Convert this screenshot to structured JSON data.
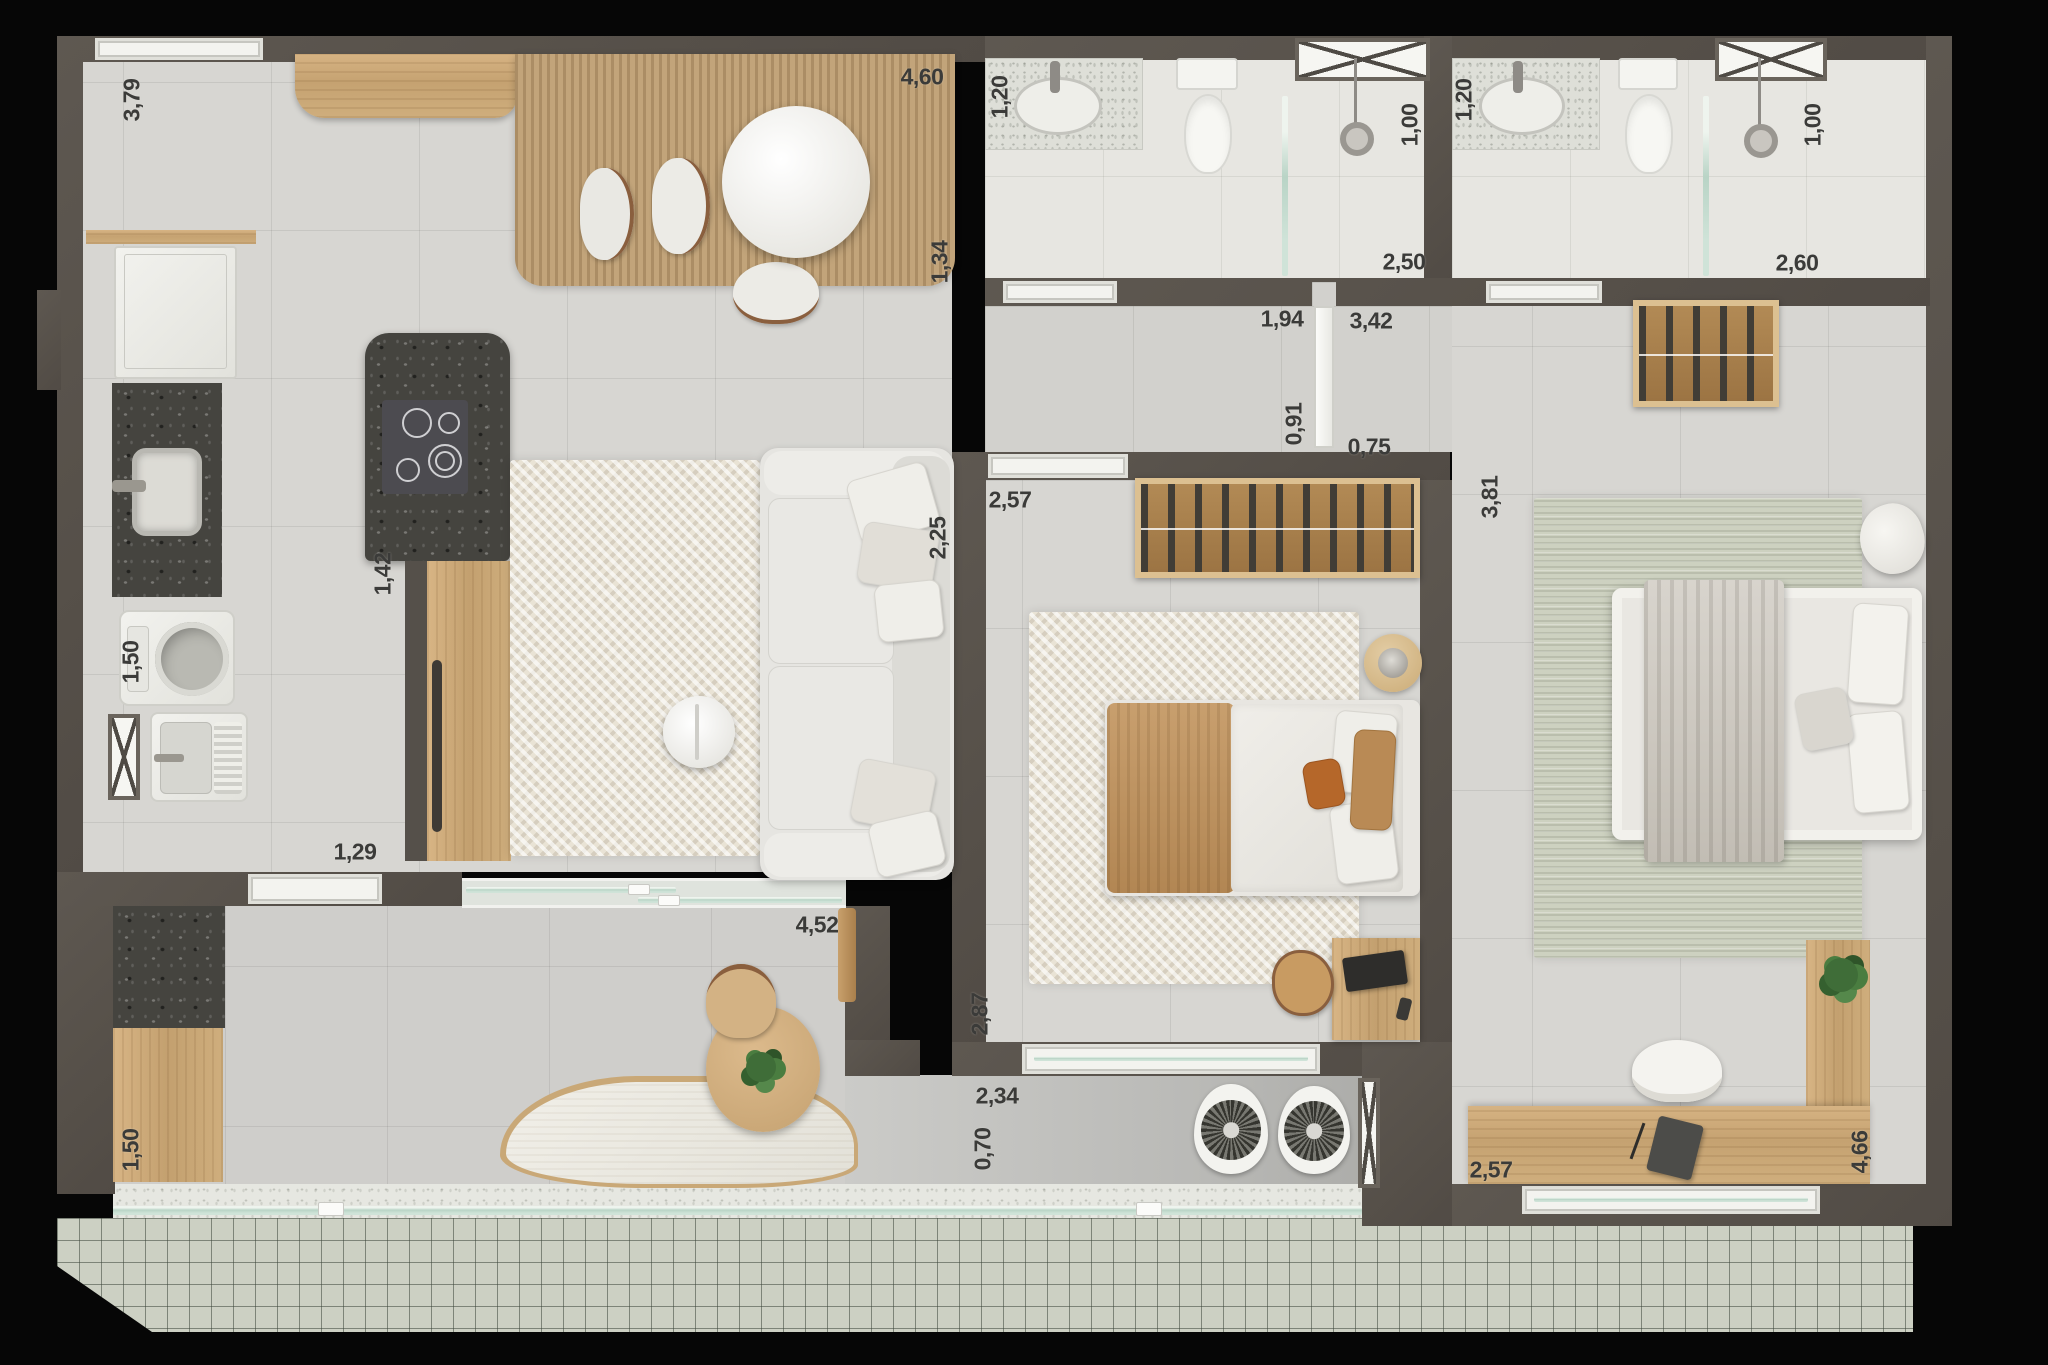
{
  "plan": {
    "kind": "apartment floor plan render, top view",
    "units": "meters (comma decimal)",
    "colors": {
      "background": "#060606",
      "wall": "#5a544d",
      "floor_tile": "#d7d6d2",
      "bath_floor": "#e7e6e1",
      "wood": "#cbaa7a",
      "dark_stone": "#45443f",
      "rug_cream": "#e9e3d5",
      "rug_tan": "#c2a47a",
      "rug_sage": "#cdd1c0",
      "glass": "#bfd8ca",
      "label_text": "#3b3b39",
      "pergola_grid": "#ccd0c3"
    }
  },
  "dims": [
    {
      "value": "3,79"
    },
    {
      "value": "4,60"
    },
    {
      "value": "1,20"
    },
    {
      "value": "1,00"
    },
    {
      "value": "2,50"
    },
    {
      "value": "1,20"
    },
    {
      "value": "1,00"
    },
    {
      "value": "2,60"
    },
    {
      "value": "1,34"
    },
    {
      "value": "1,94"
    },
    {
      "value": "3,42"
    },
    {
      "value": "0,91"
    },
    {
      "value": "0,75"
    },
    {
      "value": "2,57"
    },
    {
      "value": "3,81"
    },
    {
      "value": "2,25"
    },
    {
      "value": "1,42"
    },
    {
      "value": "1,50"
    },
    {
      "value": "1,29"
    },
    {
      "value": "4,52"
    },
    {
      "value": "2,87"
    },
    {
      "value": "2,34"
    },
    {
      "value": "0,70"
    },
    {
      "value": "2,57"
    },
    {
      "value": "4,66"
    },
    {
      "value": "1,50"
    }
  ]
}
